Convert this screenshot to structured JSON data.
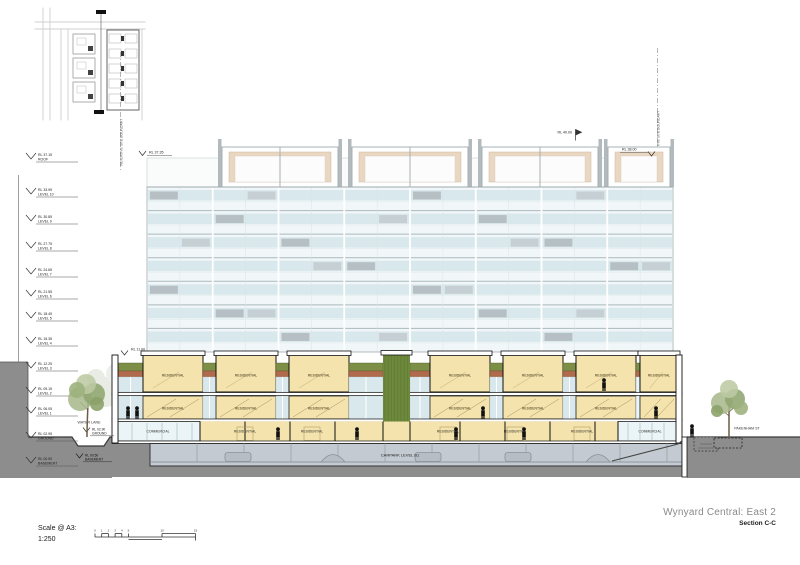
{
  "drawing": {
    "title": "Wynyard Central: East 2",
    "subtitle": "Section C-C",
    "scale_label": "Scale @ A3:",
    "scale_ratio": "1:250",
    "scale_ticks": [
      "0",
      "1",
      "2",
      "3",
      "4",
      "5",
      "10",
      "15"
    ]
  },
  "boundaries": {
    "left": "INDICATIVE SITE BOUNDARY",
    "right": "INDICATIVE SITE BOUNDARY"
  },
  "streets": {
    "left_lane": "WATER LANE",
    "right_street": "PAKENHAM ST"
  },
  "levels": [
    {
      "rl": "RL 37.15",
      "name": "ROOF"
    },
    {
      "rl": "RL 33.95",
      "name": "LEVEL 10"
    },
    {
      "rl": "RL 30.85",
      "name": "LEVEL 9"
    },
    {
      "rl": "RL 27.75",
      "name": "LEVEL 8"
    },
    {
      "rl": "RL 24.65",
      "name": "LEVEL 7"
    },
    {
      "rl": "RL 21.55",
      "name": "LEVEL 6"
    },
    {
      "rl": "RL 18.45",
      "name": "LEVEL 5"
    },
    {
      "rl": "RL 15.35",
      "name": "LEVEL 4"
    },
    {
      "rl": "RL 12.25",
      "name": "LEVEL 3"
    },
    {
      "rl": "RL 09.15",
      "name": "LEVEL 2"
    },
    {
      "rl": "RL 06.05",
      "name": "LEVEL 1"
    },
    {
      "rl": "RL 02.95",
      "name": "GROUND"
    },
    {
      "rl": "RL 00.50",
      "name": "BASEMENT"
    }
  ],
  "spot_levels": {
    "roof_left": "RL 37.35",
    "roof_center": "RL 40.00",
    "roof_right": "RL 38.00",
    "podium_top": "RL 11.00",
    "lane_ground_rl": "RL 02.90",
    "lane_ground_name": "GROUND",
    "lane_basement_rl": "RL 00.50",
    "lane_basement_name": "BASEMENT"
  },
  "podium": {
    "top_row": [
      "RESIDENTIAL",
      "RESIDENTIAL",
      "RESIDENTIAL",
      "RESIDENTIAL",
      "RESIDENTIAL",
      "RESIDENTIAL",
      "RESIDENTIAL"
    ],
    "mid_row": [
      "RESIDENTIAL",
      "RESIDENTIAL",
      "RESIDENTIAL",
      "RESIDENTIAL",
      "RESIDENTIAL",
      "RESIDENTIAL"
    ],
    "ground_row": [
      "COMMERCIAL",
      "RESIDENTIAL",
      "RESIDENTIAL",
      "RESIDENTIAL",
      "RESIDENTIAL",
      "RESIDENTIAL",
      "COMMERCIAL"
    ],
    "carpark_label": "CARPARK LEVEL B1"
  },
  "colors": {
    "unit_yellow": "#f4e3ac",
    "green_roof": "#7d8f46",
    "green_wall": "#6d893c",
    "terracotta": "#b06a4c",
    "glass": "#d9e8ec",
    "spandrel": "#b6bfc3",
    "earth": "#8d8d8d",
    "carpark": "#c4cad1",
    "penthouse_beige": "#ead7c1"
  }
}
